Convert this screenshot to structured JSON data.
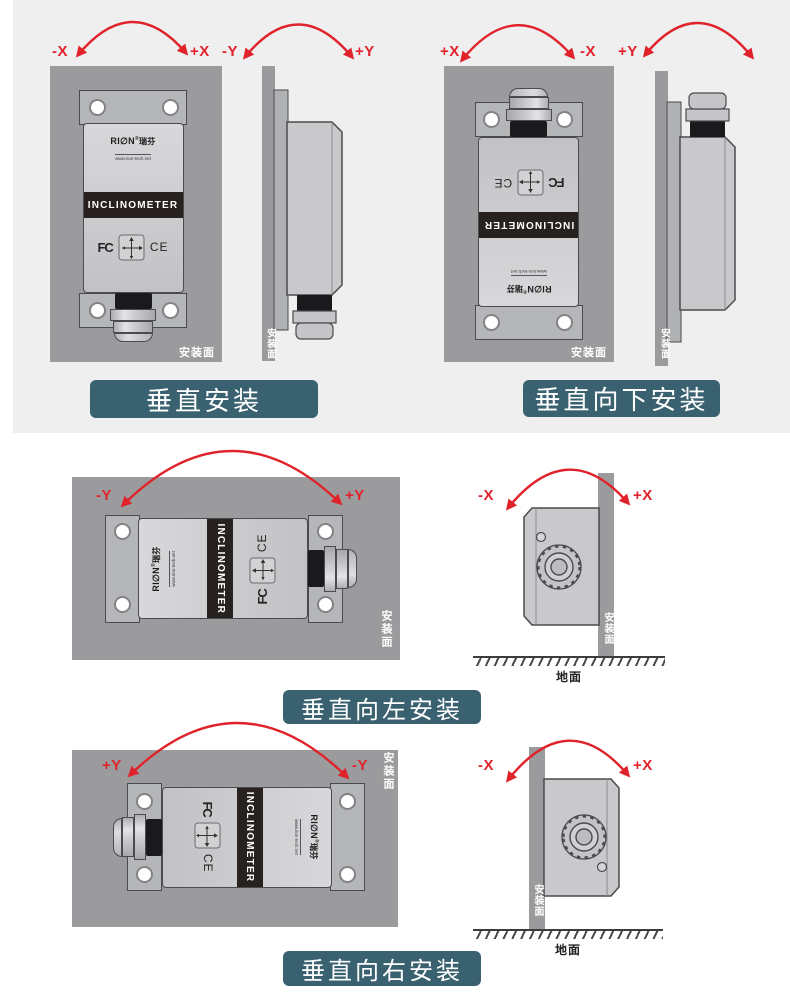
{
  "colors": {
    "accent_red": "#e0232b",
    "banner_teal": "#3a6170",
    "panel_gray": "#9b9b9d",
    "device_gray": "#c9c9cb",
    "background_band": "#efeff0"
  },
  "device": {
    "brand": "RI∅N",
    "reg": "®",
    "brand_cn": "瑞芬",
    "website": "www.rion-tech.net",
    "product_label": "INCLINOMETER",
    "cert_fcc": "FC",
    "cert_ce": "CE"
  },
  "labels": {
    "mount_surface": "安装面",
    "ground": "地面"
  },
  "sections": [
    {
      "id": "vertical",
      "title": "垂直安装",
      "front_left": "-X",
      "front_right": "+X",
      "side_left": "-Y",
      "side_right": "+Y"
    },
    {
      "id": "vertical-down",
      "title": "垂直向下安装",
      "front_left": "+X",
      "front_right": "-X",
      "side_left": "+Y",
      "side_right": ""
    },
    {
      "id": "vertical-left",
      "title": "垂直向左安装",
      "front_left": "-Y",
      "front_right": "+Y",
      "side_left": "-X",
      "side_right": "+X"
    },
    {
      "id": "vertical-right",
      "title": "垂直向右安装",
      "front_left": "+Y",
      "front_right": "-Y",
      "side_left": "-X",
      "side_right": "+X"
    }
  ]
}
